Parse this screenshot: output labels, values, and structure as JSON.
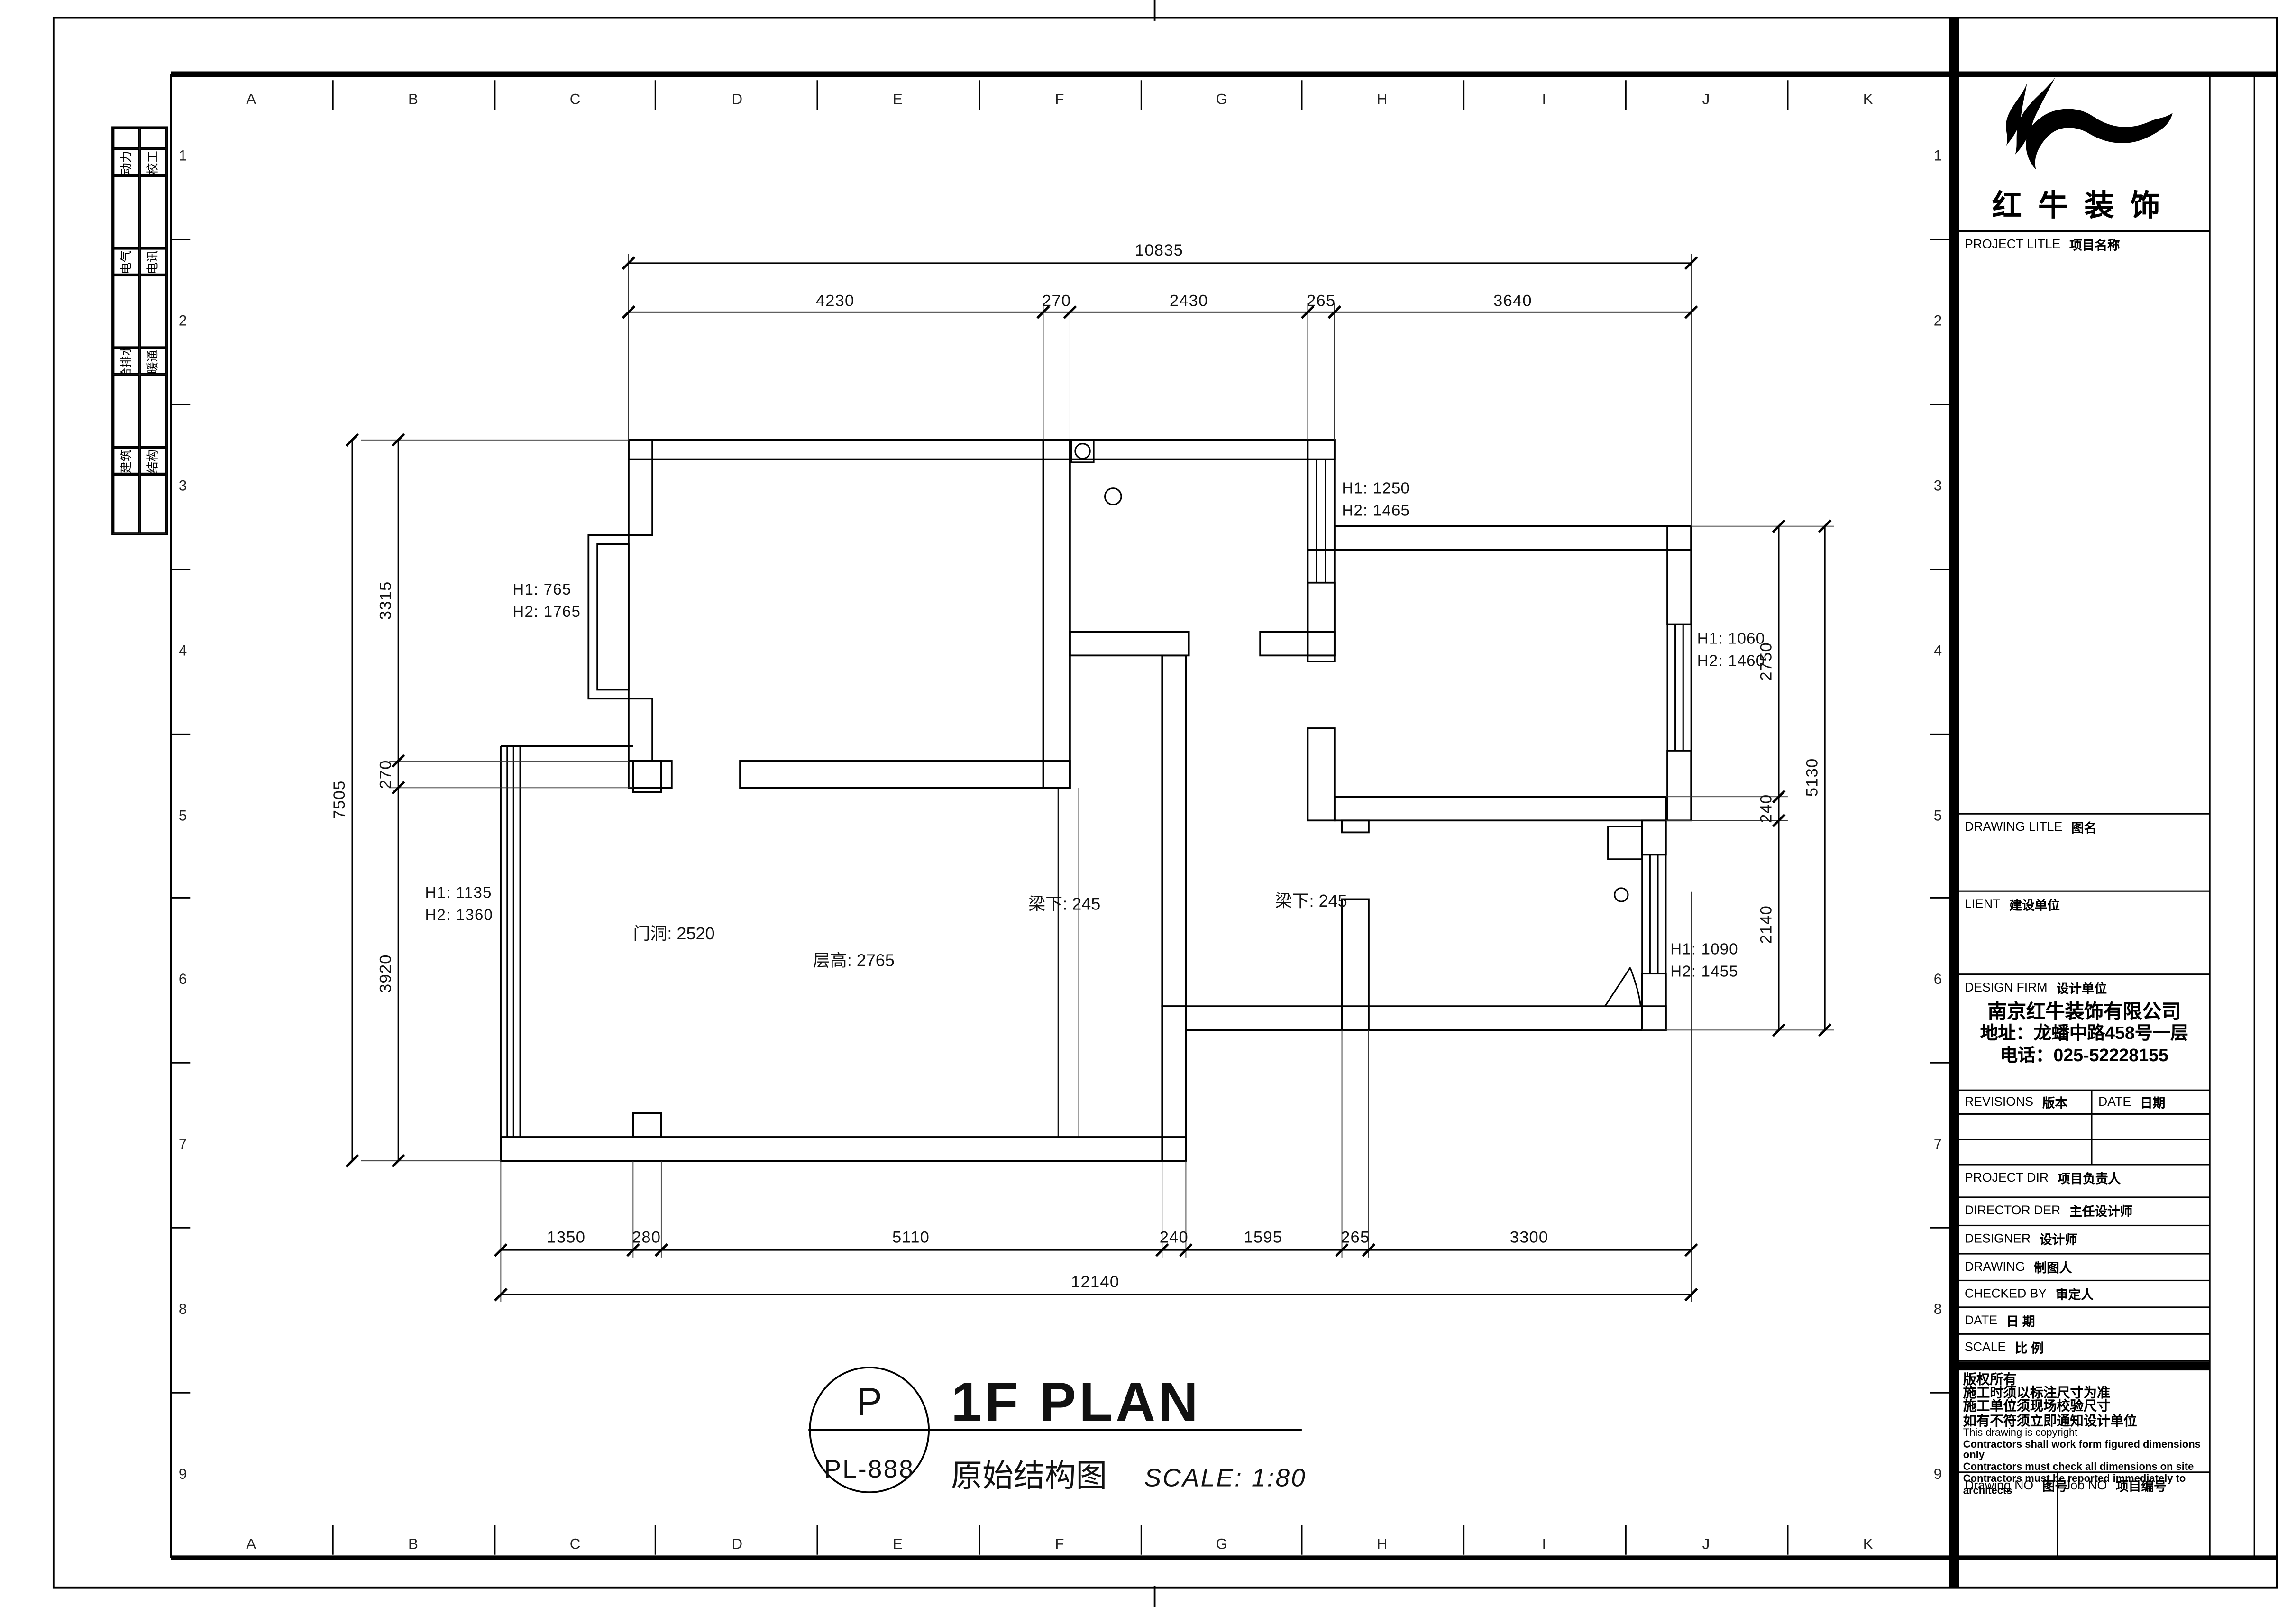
{
  "legend": {
    "pairs": [
      {
        "a": "动力",
        "b": "校工"
      },
      {
        "a": "电气",
        "b": "电讯"
      },
      {
        "a": "给排水",
        "b": "暖通"
      },
      {
        "a": "建筑",
        "b": "结构"
      }
    ]
  },
  "frame": {
    "letters": [
      "A",
      "B",
      "C",
      "D",
      "E",
      "F",
      "G",
      "H",
      "I",
      "J",
      "K"
    ],
    "numbers": [
      "1",
      "2",
      "3",
      "4",
      "5",
      "6",
      "7",
      "8",
      "9"
    ]
  },
  "plan": {
    "dims": {
      "top_total": "10835",
      "top": [
        "4230",
        "270",
        "2430",
        "265",
        "3640"
      ],
      "bottom": [
        "1350",
        "280",
        "5110",
        "240",
        "1595",
        "265",
        "3300"
      ],
      "bottom_total": "12140",
      "left": [
        "3315",
        "270",
        "3920"
      ],
      "left_total": "7505",
      "right": [
        "2750",
        "240",
        "2140"
      ],
      "right_total": "5130"
    },
    "labels": {
      "win_nw_h1": "H1: 765",
      "win_nw_h2": "H2: 1765",
      "win_balcony_h1": "H1: 1135",
      "win_balcony_h2": "H2: 1360",
      "win_bath_h1": "H1: 1250",
      "win_bath_h2": "H2: 1465",
      "win_bed2_h1": "H1: 1060",
      "win_bed2_h2": "H2: 1460",
      "win_kitchen_h1": "H1: 1090",
      "win_kitchen_h2": "H2: 1455",
      "door_opening": "门洞: 2520",
      "floor_height": "层高: 2765",
      "beam_left": "梁下: 245",
      "beam_right": "梁下: 245"
    }
  },
  "title": {
    "mark_top": "P",
    "mark_no": "PL-888",
    "name_en": "1F PLAN",
    "name_zh": "原始结构图",
    "scale_label": "SCALE: 1:80"
  },
  "titleblock": {
    "brand": "红牛装饰",
    "project_title": {
      "en": "PROJECT LITLE",
      "zh": "项目名称"
    },
    "drawing_title": {
      "en": "DRAWING LITLE",
      "zh": "图名"
    },
    "client": {
      "en": "LIENT",
      "zh": "建设单位"
    },
    "design_firm": {
      "en": "DESIGN FIRM",
      "zh": "设计单位"
    },
    "firm": {
      "name": "南京红牛装饰有限公司",
      "address": "地址：龙蟠中路458号一层",
      "phone": "电话：025-52228155"
    },
    "revisions": {
      "en": "REVISIONS",
      "zh": "版本"
    },
    "date_col": {
      "en": "DATE",
      "zh": "日期"
    },
    "rows": [
      {
        "en": "PROJECT DIR",
        "zh": "项目负责人"
      },
      {
        "en": "DIRECTOR DER",
        "zh": "主任设计师"
      },
      {
        "en": "DESIGNER",
        "zh": "设计师"
      },
      {
        "en": "DRAWING",
        "zh": "制图人"
      },
      {
        "en": "CHECKED BY",
        "zh": "审定人"
      },
      {
        "en": "DATE",
        "zh": "日 期"
      },
      {
        "en": "SCALE",
        "zh": "比 例"
      }
    ],
    "copyright": [
      "版权所有",
      "施工时须以标注尺寸为准",
      "施工单位须现场校验尺寸",
      "如有不符须立即通知设计单位",
      "This drawing is copyright",
      "Contractors shall work form figured dimensions only",
      "Contractors must check all dimensions on site",
      "Contractors must be reported immediately to architects"
    ],
    "drawing_no": {
      "en": "Drawing NO",
      "zh": "图号"
    },
    "job_no": {
      "en": "Job NO",
      "zh": "项目编号"
    }
  }
}
